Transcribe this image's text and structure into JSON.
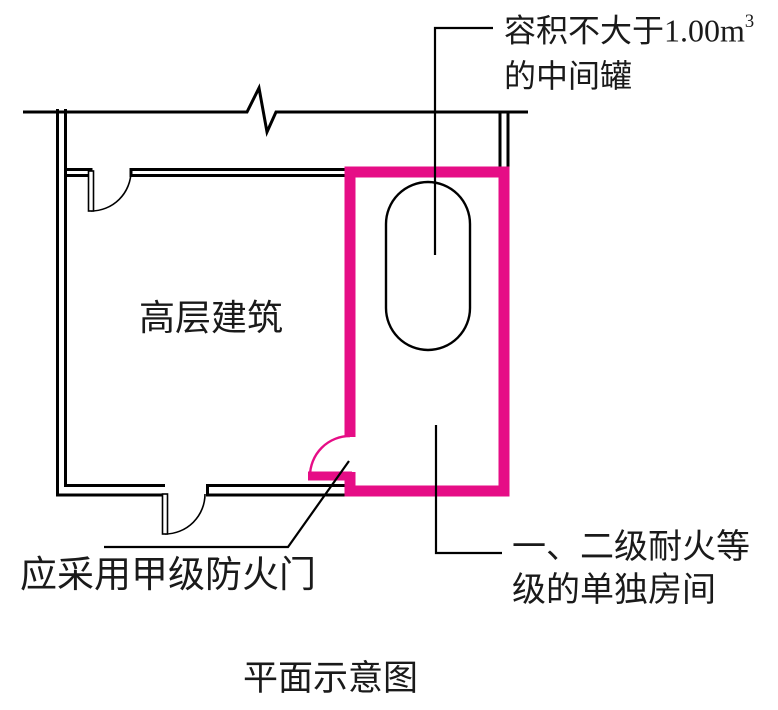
{
  "page": {
    "background": "#ffffff"
  },
  "colors": {
    "line": "#000000",
    "highlight": "#e60d86",
    "text": "#1a1a1a"
  },
  "labels": {
    "tank": {
      "line1_main": "容积不大于1.00m",
      "line1_sup": "3",
      "line2": "的中间罐"
    },
    "building": "高层建筑",
    "fire_door": "应采用甲级防火门",
    "room": {
      "line1": "一、二级耐火等",
      "line2": "级的单独房间"
    },
    "caption": "平面示意图"
  }
}
